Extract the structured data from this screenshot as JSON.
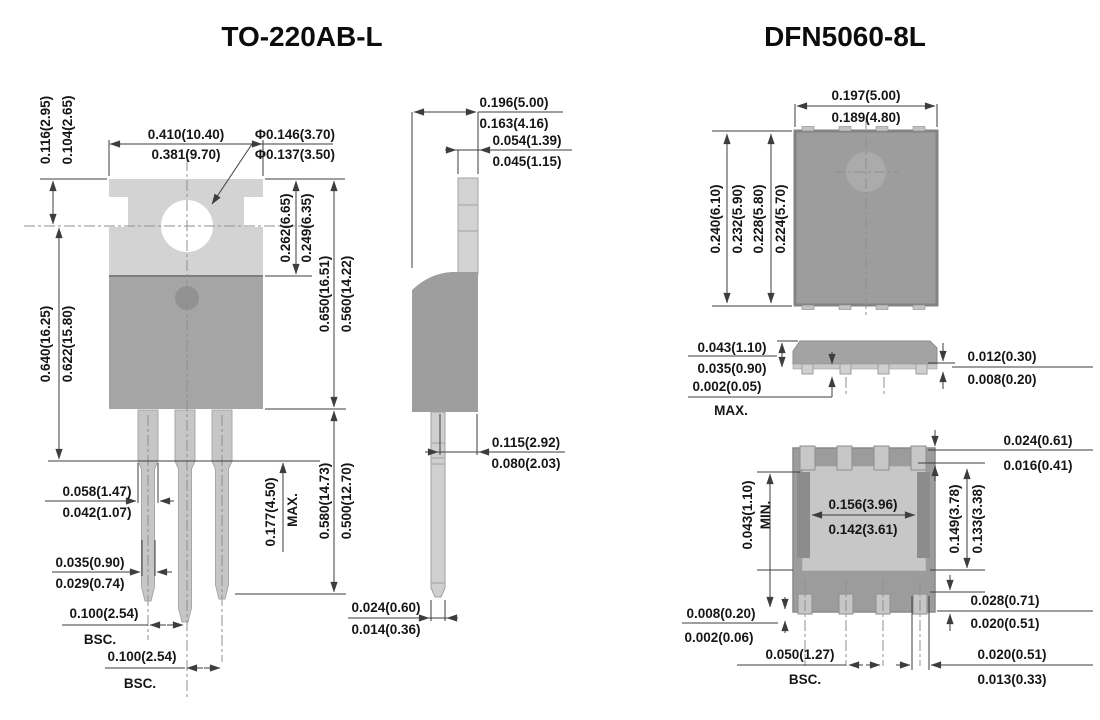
{
  "titles": {
    "left": "TO-220AB-L",
    "right": "DFN5060-8L"
  },
  "colors": {
    "tab_light": "#d3d3d3",
    "body_mid": "#a5a5a5",
    "lead_gray": "#c6c6c6",
    "dfn_body": "#9c9c9c",
    "exposed_pad": "#c7c7c7",
    "rail_dark": "#8c8c8c",
    "dim_line": "#3d3d3d",
    "text": "#161616"
  },
  "to220_front": {
    "tab_offset": [
      "0.116(2.95)",
      "0.104(2.65)"
    ],
    "body_width": [
      "0.410(10.40)",
      "0.381(9.70)"
    ],
    "hole_dia": [
      "Φ0.146(3.70)",
      "Φ0.137(3.50)"
    ],
    "hole_to_top": [
      "0.262(6.65)",
      "0.249(6.35)"
    ],
    "tab_height": [
      "0.650(16.51)",
      "0.560(14.22)"
    ],
    "overall_height": [
      "0.640(16.25)",
      "0.622(15.80)"
    ],
    "lead_width_upper": [
      "0.058(1.47)",
      "0.042(1.07)"
    ],
    "lead_width_lower": [
      "0.035(0.90)",
      "0.029(0.74)"
    ],
    "shoulder_length": [
      "0.177(4.50)",
      "MAX."
    ],
    "lead_length": [
      "0.580(14.73)",
      "0.500(12.70)"
    ],
    "pitch_1": [
      "0.100(2.54)",
      "BSC."
    ],
    "pitch_2": [
      "0.100(2.54)",
      "BSC."
    ]
  },
  "to220_side": {
    "body_depth": [
      "0.196(5.00)",
      "0.163(4.16)"
    ],
    "tab_depth": [
      "0.054(1.39)",
      "0.045(1.15)"
    ],
    "lead_offset": [
      "0.115(2.92)",
      "0.080(2.03)"
    ],
    "lead_thickness": [
      "0.024(0.60)",
      "0.014(0.36)"
    ]
  },
  "dfn_top": {
    "body_width": [
      "0.197(5.00)",
      "0.189(4.80)"
    ],
    "body_length": [
      "0.240(6.10)",
      "0.232(5.90)",
      "0.228(5.80)",
      "0.224(5.70)"
    ]
  },
  "dfn_side": {
    "body_height": [
      "0.043(1.10)",
      "0.035(0.90)"
    ],
    "standoff": [
      "0.002(0.05)",
      "MAX."
    ],
    "pad_thickness": [
      "0.012(0.30)",
      "0.008(0.20)"
    ]
  },
  "dfn_bottom": {
    "pad_pullback": [
      "0.024(0.61)",
      "0.016(0.41)"
    ],
    "edge_min": [
      "0.043(1.10)",
      "MIN."
    ],
    "epad_width": [
      "0.156(3.96)",
      "0.142(3.61)"
    ],
    "epad_length": [
      "0.149(3.78)",
      "0.133(3.38)"
    ],
    "pad_length": [
      "0.028(0.71)",
      "0.020(0.51)"
    ],
    "pad_standoff": [
      "0.008(0.20)",
      "0.002(0.06)"
    ],
    "pitch": [
      "0.050(1.27)",
      "BSC."
    ],
    "pad_width": [
      "0.020(0.51)",
      "0.013(0.33)"
    ]
  }
}
